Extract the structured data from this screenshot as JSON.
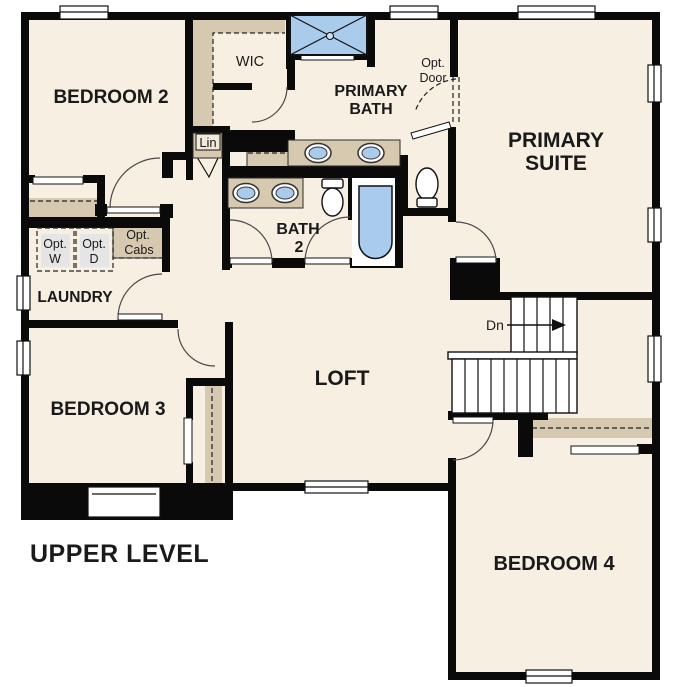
{
  "title": "UPPER LEVEL",
  "rooms": {
    "bedroom2": {
      "label": "BEDROOM 2"
    },
    "wic": {
      "label": "WIC"
    },
    "primary_bath": {
      "line1": "PRIMARY",
      "line2": "BATH"
    },
    "primary_suite": {
      "line1": "PRIMARY",
      "line2": "SUITE"
    },
    "bath2": {
      "line1": "BATH",
      "line2": "2"
    },
    "laundry": {
      "label": "LAUNDRY"
    },
    "loft": {
      "label": "LOFT"
    },
    "bedroom3": {
      "label": "BEDROOM 3"
    },
    "bedroom4": {
      "label": "BEDROOM 4"
    }
  },
  "annotations": {
    "linen": "Lin",
    "opt_door": {
      "line1": "Opt.",
      "line2": "Door"
    },
    "opt_washer": {
      "line1": "Opt.",
      "line2": "W"
    },
    "opt_dryer": {
      "line1": "Opt.",
      "line2": "D"
    },
    "opt_cabs": {
      "line1": "Opt.",
      "line2": "Cabs"
    },
    "stairs_direction": "Dn"
  },
  "fixtures": [
    "shower",
    "primary-double-vanity",
    "bath2-double-vanity",
    "primary-toilet",
    "bath2-toilet",
    "bathtub",
    "stairs-down",
    "optional-washer",
    "optional-dryer",
    "optional-cabinets",
    "linen-closet",
    "bedroom2-closet",
    "bedroom3-closet",
    "bedroom4-closet"
  ],
  "colors": {
    "background": "#ffffff",
    "floor": "#f7efe2",
    "walls": "#0a0a0a",
    "casework_tan": "#d6c9b0",
    "fixture_blue": "#a9cbec",
    "appliance_gray": "#e5e5e5"
  }
}
